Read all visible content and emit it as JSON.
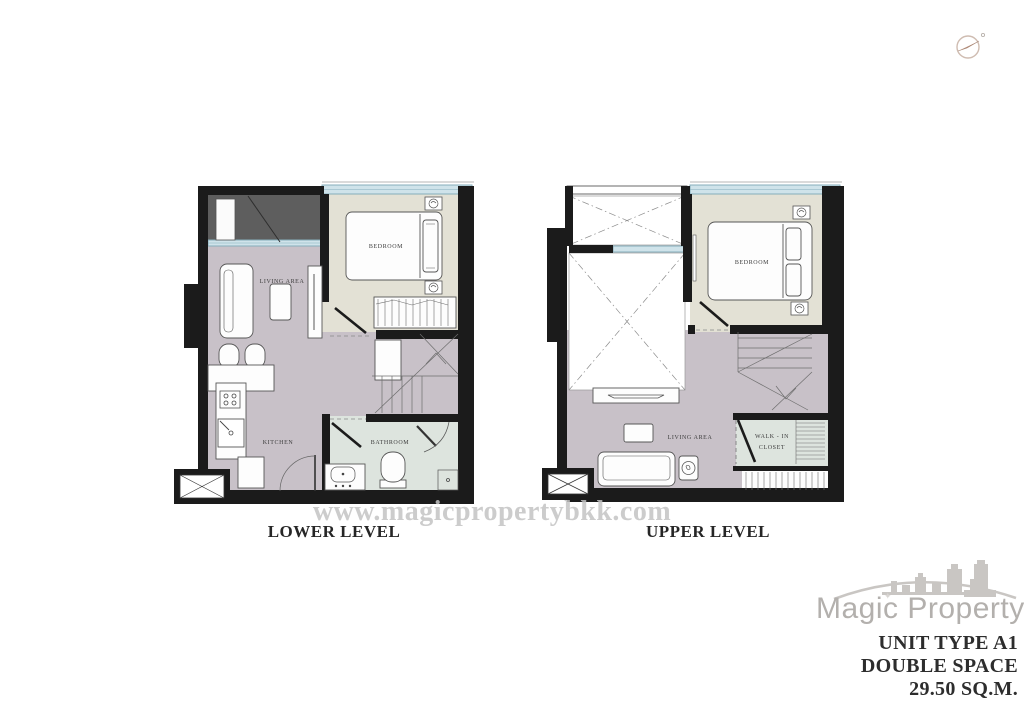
{
  "watermark": {
    "text": "www.magicpropertybkk.com"
  },
  "plans": {
    "lower": {
      "label": "LOWER LEVEL",
      "rooms": {
        "bedroom": "BEDROOM",
        "living_area": "LIVING AREA",
        "kitchen": "KITCHEN",
        "bathroom": "BATHROOM"
      }
    },
    "upper": {
      "label": "UPPER LEVEL",
      "rooms": {
        "bedroom": "BEDROOM",
        "living_area": "LIVING AREA",
        "walk_in_closet_line1": "WALK - IN",
        "walk_in_closet_line2": "CLOSET"
      }
    }
  },
  "brand": {
    "name": "Magic Property",
    "unit_type": "UNIT TYPE A1",
    "space": "DOUBLE SPACE",
    "area": "29.50 SQ.M."
  },
  "icons": {
    "sparkle": "✦"
  },
  "colors": {
    "wall": "#1b1b1b",
    "bedroom_floor": "#e3e1d5",
    "living_floor": "#c8c1c8",
    "wet_floor": "#dde4de",
    "balcony_floor": "#5e5e5e",
    "window": "#cfe3ea",
    "watermark_gray": "#c4c4c4",
    "brand_gray": "#b3b0ad",
    "text_dark": "#2d2d2d"
  }
}
